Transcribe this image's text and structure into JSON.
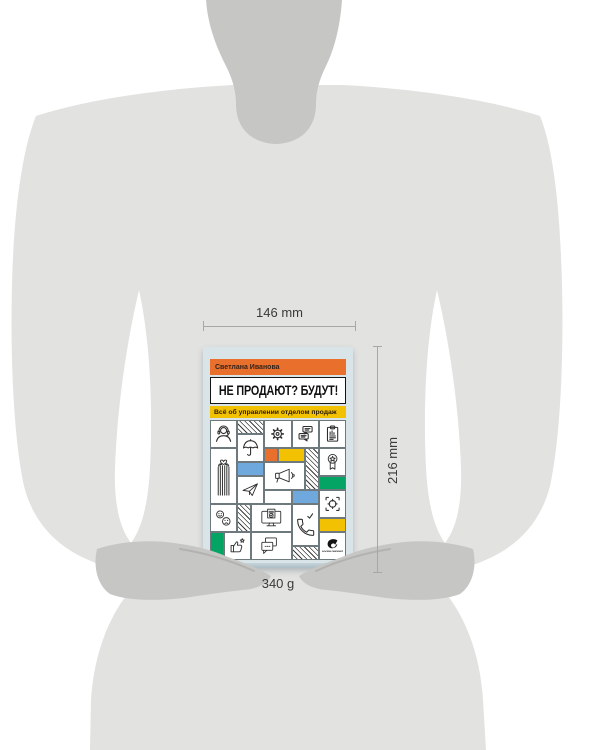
{
  "product": {
    "book": {
      "author": "Светлана Иванова",
      "title": "НЕ ПРОДАЮТ? БУДУТ!",
      "subtitle": "Всё об управлении отделом продаж",
      "publisher": "АЛЬПИНА ПАБЛИШЕР"
    },
    "dimensions": {
      "width": "146 mm",
      "height": "216 mm",
      "weight": "340 g"
    },
    "cover_icons": [
      "headset-support",
      "hatch-pattern",
      "umbrella",
      "gear",
      "chat-bubbles",
      "clipboard-chart",
      "hands-holding-heart",
      "orange-block",
      "yellow-block",
      "megaphone",
      "award-ribbon",
      "blue-block",
      "paper-plane",
      "green-block",
      "emoji-faces",
      "monitor-document",
      "phone-call-check",
      "target-crosshair",
      "thumbs-up-star",
      "speech-bubbles",
      "publisher-logo"
    ],
    "colors": {
      "orange": "#E8702C",
      "yellow": "#F2C202",
      "blue": "#6FA8DC",
      "green": "#03A464",
      "cover_background": "#D8E4E8"
    }
  }
}
